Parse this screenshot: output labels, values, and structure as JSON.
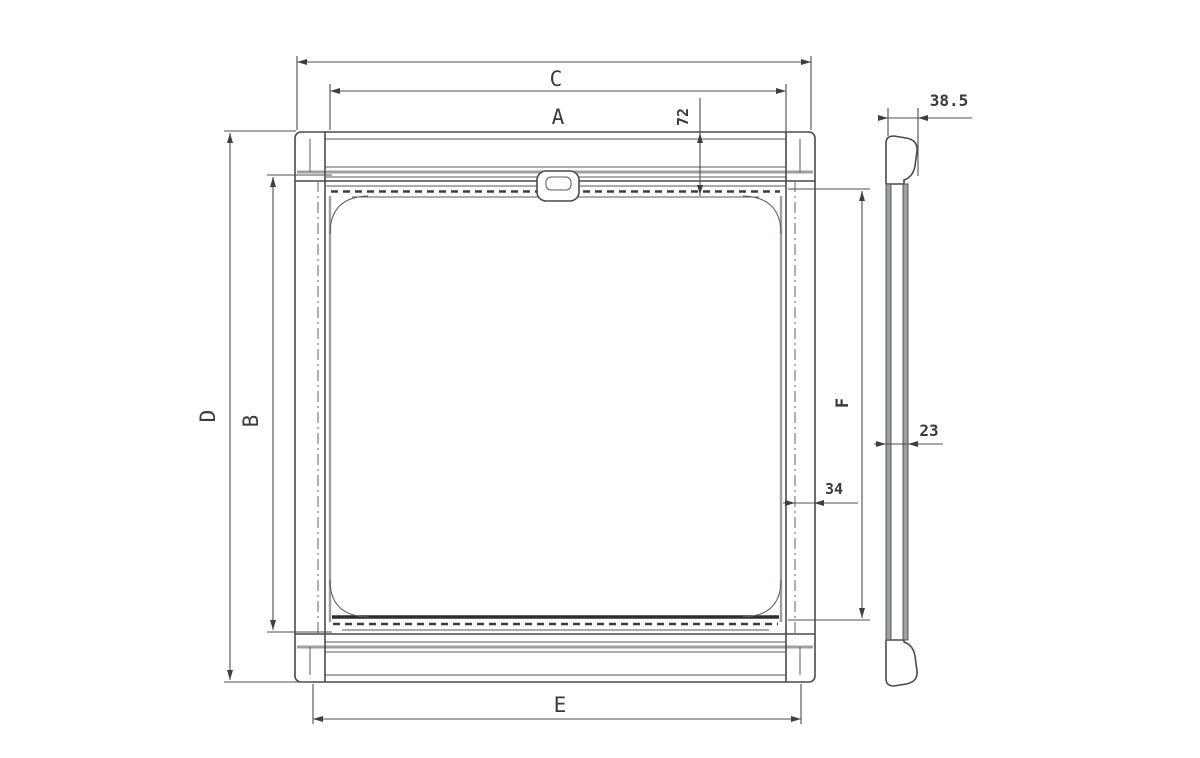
{
  "drawing": {
    "name": "window-blind-technical-drawing",
    "labels": {
      "c": "C",
      "a": "A",
      "d": "D",
      "b": "B",
      "e": "E",
      "f": "F",
      "n72": "72",
      "n34": "34",
      "n23": "23",
      "n385": "38.5"
    },
    "colors": {
      "line": "#4a4a4a",
      "gray_accent": "#9aa0a3",
      "background": "#ffffff"
    }
  }
}
